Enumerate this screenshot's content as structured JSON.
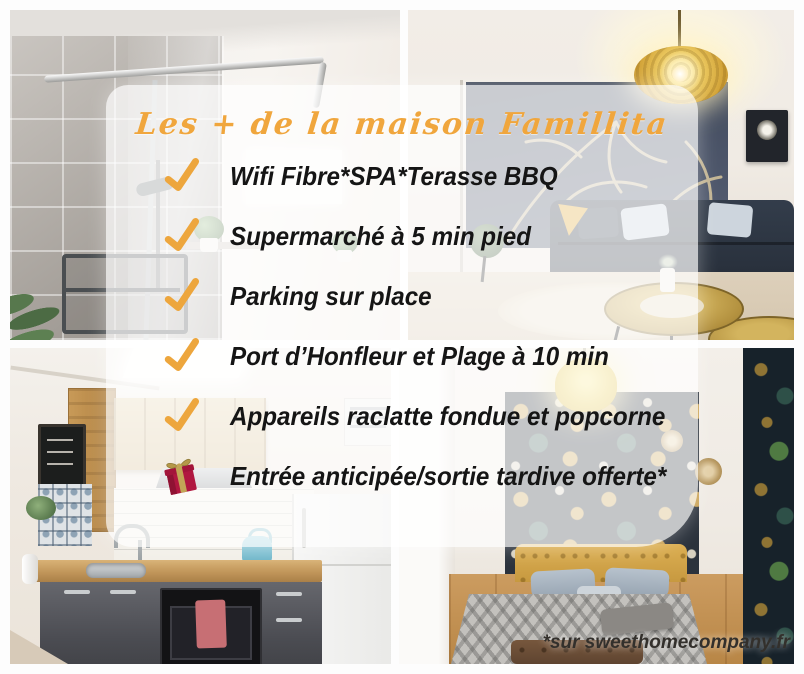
{
  "poster": {
    "title": "Les + de la maison Famillita",
    "amenities": [
      {
        "icon": "check",
        "label": "Wifi Fibre*SPA*Terasse BBQ"
      },
      {
        "icon": "check",
        "label": "Supermarché à 5 min pied"
      },
      {
        "icon": "check",
        "label": "Parking sur place"
      },
      {
        "icon": "check",
        "label": "Port d’Honfleur et Plage à 10 min"
      },
      {
        "icon": "check",
        "label": "Appareils raclatte fondue et popcorne"
      },
      {
        "icon": "gift",
        "label": "Entrée anticipée/sortie tardive offerte*"
      }
    ],
    "footnote": "*sur sweethomecompany.fr",
    "photos": [
      {
        "name": "bathroom-shower"
      },
      {
        "name": "living-room"
      },
      {
        "name": "kitchen"
      },
      {
        "name": "bedroom"
      }
    ],
    "colors": {
      "accent_orange": "#F0A63D",
      "text_black": "#151515",
      "card_background": "rgba(255,255,255,0.72)",
      "gift_red": "#B01740",
      "gift_gold": "#C2A556"
    }
  }
}
